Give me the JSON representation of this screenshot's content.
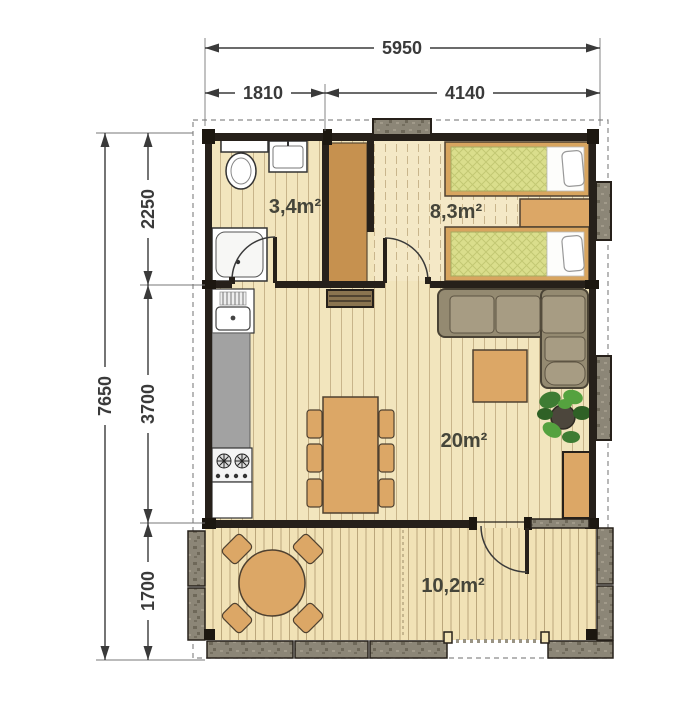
{
  "plan": {
    "dims": {
      "w_total": "5950",
      "w_left": "1810",
      "w_right": "4140",
      "h_total": "7650",
      "h_top": "2250",
      "h_mid": "3700",
      "h_bot": "1700"
    },
    "rooms": {
      "bathroom": "3,4m²",
      "bedroom": "8,3m²",
      "living": "20m²",
      "terrace": "10,2m²"
    },
    "colors": {
      "wall": "#26201a",
      "floor": "#f2e5bd",
      "wood_furniture": "#dca766",
      "wardrobe_wood": "#c6914f",
      "mattress_green": "#dade8c",
      "sofa_taupe": "#948a71",
      "kitchen_counter": "#a2a2a2",
      "railing_stone": "#8c8677",
      "plant_green": "#3e7c33",
      "dimension_ink": "#3a3a3a"
    }
  }
}
